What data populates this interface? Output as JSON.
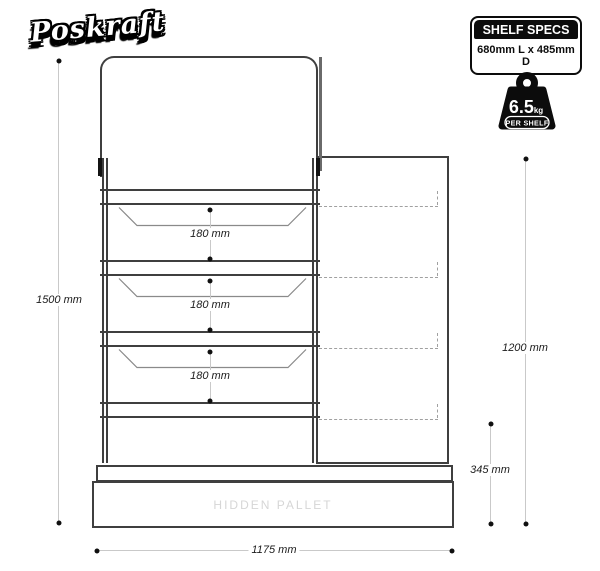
{
  "logo": {
    "text": "Poskraft"
  },
  "spec_box": {
    "title": "SHELF SPECS",
    "subtitle": "680mm L x 485mm D"
  },
  "weight_badge": {
    "value": "6.5",
    "unit": "kg",
    "label": "PER SHELF"
  },
  "diagram": {
    "pallet_label": "HIDDEN PALLET",
    "shelf_gaps": [
      "180 mm",
      "180 mm",
      "180 mm"
    ],
    "dim_total_height": "1500 mm",
    "dim_shelving_height": "1200 mm",
    "dim_base_height": "345 mm",
    "dim_width": "1175 mm"
  },
  "colors": {
    "line": "#3f3f3f",
    "dim_line": "#c9c9c9",
    "dashed": "#a0a0a0",
    "muted_text": "#d6d6d6",
    "ink": "#0c0c0c"
  }
}
